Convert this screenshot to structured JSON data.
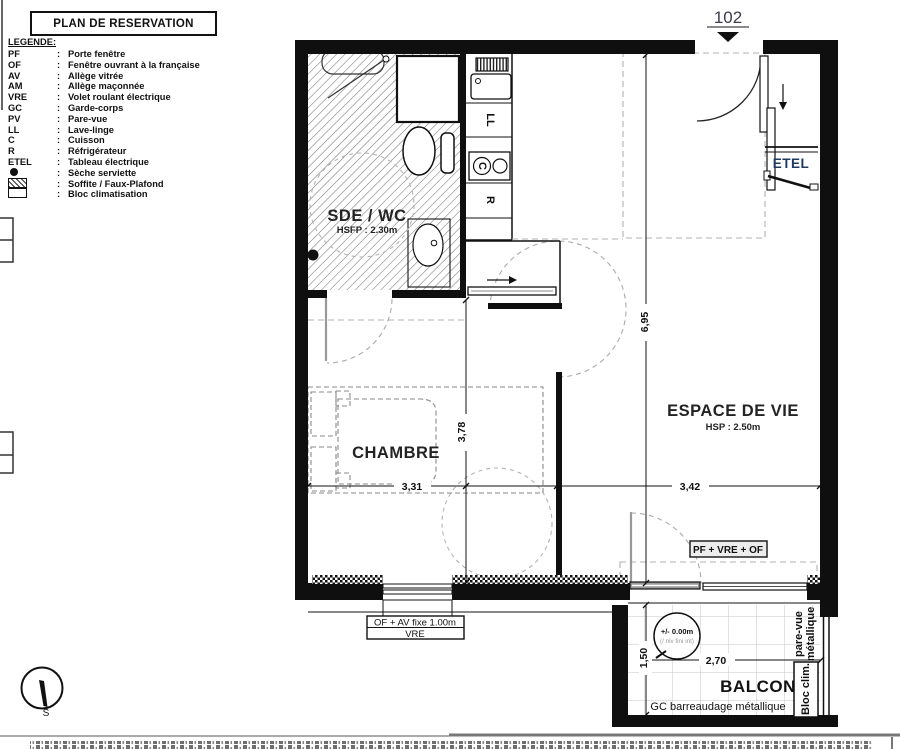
{
  "title": "PLAN DE RESERVATION",
  "legend": {
    "heading": "LEGENDE:",
    "colon": ":",
    "items": [
      {
        "abbr": "PF",
        "desc": "Porte fenêtre"
      },
      {
        "abbr": "OF",
        "desc": "Fenêtre ouvrant à la française"
      },
      {
        "abbr": "AV",
        "desc": "Allège vitrée"
      },
      {
        "abbr": "AM",
        "desc": "Allège maçonnée"
      },
      {
        "abbr": "VRE",
        "desc": "Volet roulant électrique"
      },
      {
        "abbr": "GC",
        "desc": "Garde-corps"
      },
      {
        "abbr": "PV",
        "desc": "Pare-vue"
      },
      {
        "abbr": "LL",
        "desc": "Lave-linge"
      },
      {
        "abbr": "C",
        "desc": "Cuisson"
      },
      {
        "abbr": "R",
        "desc": "Réfrigérateur"
      },
      {
        "abbr": "ETEL",
        "desc": "Tableau électrique"
      },
      {
        "symbol": "dot",
        "desc": "Sèche serviette"
      },
      {
        "symbol": "hatch",
        "desc": "Soffite / Faux-Plafond"
      },
      {
        "symbol": "box",
        "desc": "Bloc climatisation"
      }
    ]
  },
  "apartment_number": "102",
  "rooms": {
    "sde_wc": {
      "name": "SDE / WC",
      "note": "HSFP : 2.30m"
    },
    "chambre": {
      "name": "CHAMBRE"
    },
    "espace_de_vie": {
      "name": "ESPACE DE VIE",
      "note": "HSP : 2.50m"
    },
    "balcon": {
      "name": "BALCON",
      "railing": "GC barreaudage métallique"
    }
  },
  "labels": {
    "etel": "ETEL",
    "ll": "LL",
    "c": "C",
    "r": "R",
    "living_window": "PF + VRE + OF",
    "bedroom_window_line1": "OF + AV fixe 1.00m",
    "bedroom_window_line2": "VRE",
    "bloc_clim": "Bloc clim.",
    "pare_vue_line1": "pare-vue",
    "pare_vue_line2": "métallique",
    "level_line1": "+/- 0.00m",
    "level_line2": "(/ niv fini int)",
    "compass_south": "S"
  },
  "dimensions": {
    "unit_depth": "6,95",
    "chambre_depth": "3,78",
    "chambre_width": "3,31",
    "living_width": "3,42",
    "balcony_width": "2,70",
    "balcony_depth": "1,50"
  },
  "colors": {
    "accent_text": "#1f3864",
    "line": "#111111"
  }
}
